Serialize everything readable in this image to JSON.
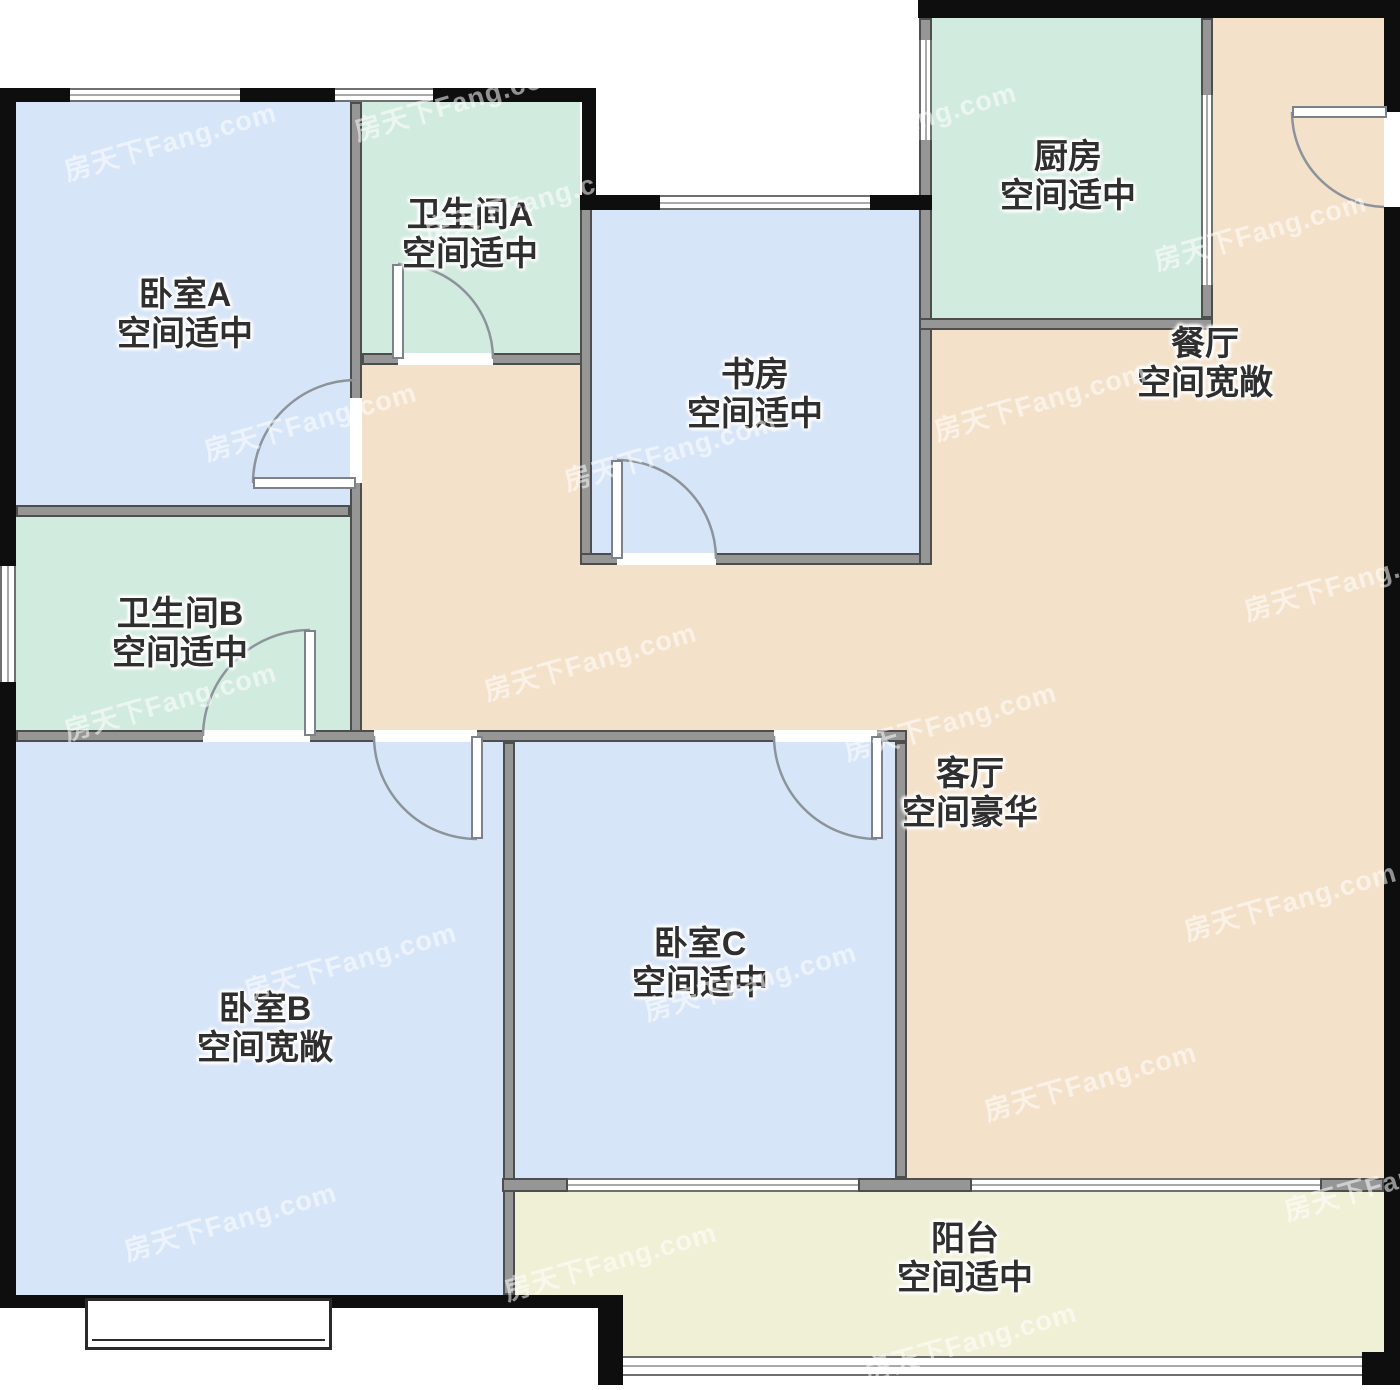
{
  "title": "户型图 floor plan",
  "watermark": {
    "text": "房天下Fang.com"
  },
  "colors": {
    "blue": "#d7e5f8",
    "green": "#d2ebdf",
    "peach": "#f4e1ca",
    "balcony": "#f0f0d7",
    "wall_gray": "#969696",
    "wall_black": "#0e0e0e",
    "arc": "#8d939b",
    "text": "#2f2f2f"
  },
  "rooms": [
    {
      "id": "bedroom-a",
      "name": "卧室A",
      "status": "空间适中",
      "cx": 185,
      "ty": 276
    },
    {
      "id": "bathroom-a",
      "name": "卫生间A",
      "status": "空间适中",
      "cx": 470,
      "ty": 196
    },
    {
      "id": "study",
      "name": "书房",
      "status": "空间适中",
      "cx": 755,
      "ty": 356
    },
    {
      "id": "kitchen",
      "name": "厨房",
      "status": "空间适中",
      "cx": 1068,
      "ty": 138
    },
    {
      "id": "dining",
      "name": "餐厅",
      "status": "空间宽敞",
      "cx": 1205,
      "ty": 325
    },
    {
      "id": "bathroom-b",
      "name": "卫生间B",
      "status": "空间适中",
      "cx": 180,
      "ty": 595
    },
    {
      "id": "living",
      "name": "客厅",
      "status": "空间豪华",
      "cx": 970,
      "ty": 755
    },
    {
      "id": "bedroom-c",
      "name": "卧室C",
      "status": "空间适中",
      "cx": 700,
      "ty": 925
    },
    {
      "id": "bedroom-b",
      "name": "卧室B",
      "status": "空间宽敞",
      "cx": 265,
      "ty": 990
    },
    {
      "id": "balcony",
      "name": "阳台",
      "status": "空间适中",
      "cx": 965,
      "ty": 1220
    }
  ],
  "geometry": {
    "rects": [
      {
        "n": "hall-dining-area-fill",
        "cls": "fill",
        "c": "peach",
        "x": 356,
        "y": 330,
        "w": 1028,
        "h": 412
      },
      {
        "n": "dining-upper-fill",
        "cls": "fill",
        "c": "peach",
        "x": 1213,
        "y": 18,
        "w": 171,
        "h": 312
      },
      {
        "n": "living-room-fill",
        "cls": "fill",
        "c": "peach",
        "x": 907,
        "y": 742,
        "w": 477,
        "h": 436
      },
      {
        "n": "bedroom-a-fill",
        "cls": "fill",
        "c": "blue",
        "x": 16,
        "y": 102,
        "w": 334,
        "h": 403
      },
      {
        "n": "bathroom-a-fill",
        "cls": "fill",
        "c": "green",
        "x": 362,
        "y": 102,
        "w": 218,
        "h": 251
      },
      {
        "n": "study-fill",
        "cls": "fill",
        "c": "blue",
        "x": 592,
        "y": 210,
        "w": 327,
        "h": 343
      },
      {
        "n": "kitchen-fill",
        "cls": "fill",
        "c": "green",
        "x": 932,
        "y": 18,
        "w": 269,
        "h": 300
      },
      {
        "n": "bathroom-b-fill",
        "cls": "fill",
        "c": "green",
        "x": 16,
        "y": 517,
        "w": 334,
        "h": 213
      },
      {
        "n": "bedroom-b-fill",
        "cls": "fill",
        "c": "blue",
        "x": 16,
        "y": 742,
        "w": 487,
        "h": 553
      },
      {
        "n": "bedroom-c-fill",
        "cls": "fill",
        "c": "blue",
        "x": 515,
        "y": 742,
        "w": 380,
        "h": 436
      },
      {
        "n": "balcony-fill-upper",
        "cls": "fill",
        "c": "balcony",
        "x": 515,
        "y": 1192,
        "w": 869,
        "h": 103
      },
      {
        "n": "balcony-fill-lower",
        "cls": "fill",
        "c": "balcony",
        "x": 623,
        "y": 1295,
        "w": 761,
        "h": 61
      },
      {
        "n": "wall-bedroom-a-right",
        "cls": "wg",
        "x": 350,
        "y": 102,
        "w": 12,
        "h": 640
      },
      {
        "n": "wall-bedroom-a-bottom",
        "cls": "wg",
        "x": 16,
        "y": 505,
        "w": 334,
        "h": 12
      },
      {
        "n": "wall-bathroom-a-bottom",
        "cls": "wg",
        "x": 362,
        "y": 353,
        "w": 230,
        "h": 12
      },
      {
        "n": "wall-study-left",
        "cls": "wg",
        "x": 580,
        "y": 195,
        "w": 12,
        "h": 370
      },
      {
        "n": "wall-study-bottom",
        "cls": "wg",
        "x": 580,
        "y": 553,
        "w": 352,
        "h": 12
      },
      {
        "n": "wall-study-kitchen",
        "cls": "wg",
        "x": 919,
        "y": 18,
        "w": 13,
        "h": 547
      },
      {
        "n": "wall-kitchen-bottom",
        "cls": "wg",
        "x": 919,
        "y": 318,
        "w": 294,
        "h": 12
      },
      {
        "n": "wall-kitchen-right",
        "cls": "wg",
        "x": 1201,
        "y": 18,
        "w": 12,
        "h": 300
      },
      {
        "n": "wall-hall-bedrooms",
        "cls": "wg",
        "x": 16,
        "y": 730,
        "w": 891,
        "h": 12
      },
      {
        "n": "wall-bedroom-b-c",
        "cls": "wg",
        "x": 503,
        "y": 742,
        "w": 12,
        "h": 553
      },
      {
        "n": "wall-bedroom-c-living",
        "cls": "wg",
        "x": 895,
        "y": 742,
        "w": 12,
        "h": 436
      },
      {
        "n": "wall-balcony-stub-left",
        "cls": "wg",
        "x": 502,
        "y": 1178,
        "w": 66,
        "h": 14
      },
      {
        "n": "wall-balcony-stub-mid",
        "cls": "wg",
        "x": 858,
        "y": 1178,
        "w": 114,
        "h": 14
      },
      {
        "n": "wall-balcony-stub-right",
        "cls": "wg",
        "x": 1320,
        "y": 1178,
        "w": 64,
        "h": 14
      },
      {
        "n": "ext-wall-top-1",
        "cls": "wb",
        "x": 4,
        "y": 88,
        "w": 66,
        "h": 14
      },
      {
        "n": "ext-wall-top-2",
        "cls": "wb",
        "x": 240,
        "y": 88,
        "w": 95,
        "h": 14
      },
      {
        "n": "ext-wall-top-3",
        "cls": "wb",
        "x": 433,
        "y": 88,
        "w": 163,
        "h": 14
      },
      {
        "n": "ext-wall-notch-left",
        "cls": "wb",
        "x": 582,
        "y": 88,
        "w": 14,
        "h": 122
      },
      {
        "n": "ext-wall-left",
        "cls": "wb",
        "x": 0,
        "y": 88,
        "w": 16,
        "h": 1220
      },
      {
        "n": "ext-wall-study-top-l",
        "cls": "wb",
        "x": 580,
        "y": 195,
        "w": 80,
        "h": 15
      },
      {
        "n": "ext-wall-study-top-r",
        "cls": "wb",
        "x": 870,
        "y": 195,
        "w": 62,
        "h": 15
      },
      {
        "n": "ext-wall-top-right",
        "cls": "wb",
        "x": 918,
        "y": 0,
        "w": 482,
        "h": 18
      },
      {
        "n": "ext-wall-right",
        "cls": "wb",
        "x": 1384,
        "y": 0,
        "w": 16,
        "h": 1385
      },
      {
        "n": "ext-wall-bedroom-b-bottom",
        "cls": "wb",
        "x": 0,
        "y": 1295,
        "w": 610,
        "h": 13
      },
      {
        "n": "ext-wall-balcony-left",
        "cls": "wb",
        "x": 598,
        "y": 1295,
        "w": 25,
        "h": 90
      },
      {
        "n": "ext-wall-balcony-br",
        "cls": "wb",
        "x": 1362,
        "y": 1352,
        "w": 38,
        "h": 33
      },
      {
        "n": "window-bedroom-a-1",
        "cls": "win-h",
        "x": 70,
        "y": 88,
        "w": 170,
        "h": 14
      },
      {
        "n": "window-bedroom-a-2",
        "cls": "win-h",
        "x": 335,
        "y": 88,
        "w": 98,
        "h": 14
      },
      {
        "n": "window-bathroom-b",
        "cls": "win-v",
        "x": 0,
        "y": 566,
        "w": 16,
        "h": 116
      },
      {
        "n": "window-study",
        "cls": "win-h",
        "x": 660,
        "y": 195,
        "w": 210,
        "h": 15
      },
      {
        "n": "window-kitchen-left",
        "cls": "win-v",
        "x": 919,
        "y": 40,
        "w": 13,
        "h": 100
      },
      {
        "n": "window-balcony-top-left",
        "cls": "win-h",
        "x": 568,
        "y": 1178,
        "w": 290,
        "h": 14
      },
      {
        "n": "window-balcony-top-right",
        "cls": "win-h",
        "x": 972,
        "y": 1178,
        "w": 348,
        "h": 14
      },
      {
        "n": "window-balcony-bottom",
        "cls": "win-h",
        "x": 623,
        "y": 1356,
        "w": 739,
        "h": 20
      },
      {
        "n": "slider-kitchen-dining",
        "cls": "win-v",
        "x": 1201,
        "y": 95,
        "w": 12,
        "h": 190
      },
      {
        "n": "opening-bedroom-a",
        "cls": "open",
        "x": 350,
        "y": 398,
        "w": 12,
        "h": 85
      },
      {
        "n": "opening-bathroom-a",
        "cls": "open",
        "x": 398,
        "y": 353,
        "w": 95,
        "h": 12
      },
      {
        "n": "opening-study",
        "cls": "open",
        "x": 617,
        "y": 553,
        "w": 99,
        "h": 12
      },
      {
        "n": "opening-bathroom-b",
        "cls": "open",
        "x": 203,
        "y": 730,
        "w": 107,
        "h": 12
      },
      {
        "n": "opening-bedroom-b",
        "cls": "open",
        "x": 374,
        "y": 730,
        "w": 103,
        "h": 12
      },
      {
        "n": "opening-bedroom-c",
        "cls": "open",
        "x": 774,
        "y": 730,
        "w": 103,
        "h": 12
      },
      {
        "n": "opening-entry",
        "cls": "open",
        "x": 1384,
        "y": 112,
        "w": 16,
        "h": 95
      },
      {
        "n": "door-leaf-bedroom-a",
        "cls": "leaf",
        "x": 253,
        "y": 477,
        "w": 103,
        "h": 12
      },
      {
        "n": "door-leaf-bathroom-a",
        "cls": "leaf",
        "x": 392,
        "y": 264,
        "w": 12,
        "h": 95
      },
      {
        "n": "door-leaf-study",
        "cls": "leaf",
        "x": 611,
        "y": 460,
        "w": 12,
        "h": 99
      },
      {
        "n": "door-leaf-bathroom-b",
        "cls": "leaf",
        "x": 304,
        "y": 630,
        "w": 12,
        "h": 106
      },
      {
        "n": "door-leaf-bedroom-b",
        "cls": "leaf",
        "x": 471,
        "y": 736,
        "w": 12,
        "h": 103
      },
      {
        "n": "door-leaf-bedroom-c",
        "cls": "leaf",
        "x": 871,
        "y": 736,
        "w": 12,
        "h": 103
      },
      {
        "n": "door-leaf-entry",
        "cls": "leaf",
        "x": 1292,
        "y": 106,
        "w": 95,
        "h": 12
      },
      {
        "n": "bay-window-bedroom-b",
        "cls": "bay",
        "x": 85,
        "y": 1298,
        "w": 247,
        "h": 52
      }
    ],
    "arcs": [
      {
        "n": "door-arc-bedroom-a",
        "d": "M 253 483 A 103 103 0 0 1 356 380"
      },
      {
        "n": "door-arc-bathroom-a",
        "d": "M 398 264 A 95 95 0 0 1 493 359"
      },
      {
        "n": "door-arc-study",
        "d": "M 617 460 A 99 99 0 0 1 716 559"
      },
      {
        "n": "door-arc-bathroom-b",
        "d": "M 203 736 A 107 107 0 0 1 310 630"
      },
      {
        "n": "door-arc-bedroom-b",
        "d": "M 374 736 A 103 103 0 0 0 477 839"
      },
      {
        "n": "door-arc-bedroom-c",
        "d": "M 774 736 A 103 103 0 0 0 877 839"
      },
      {
        "n": "door-arc-entry",
        "d": "M 1292 112 A 95 95 0 0 0 1384 207"
      }
    ],
    "watermarks": [
      {
        "x": 60,
        "y": 120
      },
      {
        "x": 420,
        "y": 180
      },
      {
        "x": 800,
        "y": 100
      },
      {
        "x": 1150,
        "y": 210
      },
      {
        "x": 200,
        "y": 400
      },
      {
        "x": 560,
        "y": 430
      },
      {
        "x": 930,
        "y": 380
      },
      {
        "x": 1240,
        "y": 560
      },
      {
        "x": 60,
        "y": 680
      },
      {
        "x": 480,
        "y": 640
      },
      {
        "x": 840,
        "y": 700
      },
      {
        "x": 1180,
        "y": 880
      },
      {
        "x": 240,
        "y": 940
      },
      {
        "x": 640,
        "y": 960
      },
      {
        "x": 980,
        "y": 1060
      },
      {
        "x": 1280,
        "y": 1160
      },
      {
        "x": 120,
        "y": 1200
      },
      {
        "x": 500,
        "y": 1240
      },
      {
        "x": 860,
        "y": 1320
      },
      {
        "x": 350,
        "y": 80
      }
    ]
  }
}
